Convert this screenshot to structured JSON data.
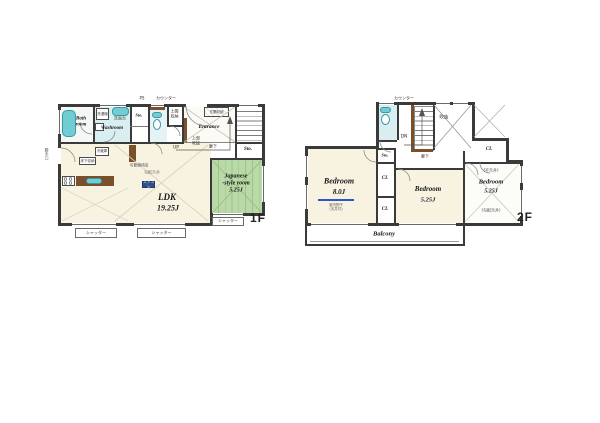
{
  "colors": {
    "wall": "#3a3a3a",
    "fixture_teal": "#72ccd4",
    "tatami_green": "#b9d9a7",
    "floor_cream": "#f8f3e1",
    "wet_floor_cyan": "#d8eef1",
    "wood_brown": "#7a4f2b",
    "laundry_blue": "#2b57c8"
  },
  "f1": {
    "floor": "1F",
    "ps": "PS",
    "counter": "カウンター",
    "bath_l1": "Bath",
    "bath_l2": "room",
    "washer": "洗濯機",
    "vanity": "洗面台",
    "washroom": "Washroom",
    "sto_hall": "Sto.",
    "doma_l1": "土間",
    "doma_l2": "収納",
    "genkan_sto": "玄関収納",
    "entrance": "Entrance",
    "up": "UP",
    "void_l1": "上部",
    "void_l2": "吹抜",
    "hallway": "廊下",
    "sto_east": "Sto.",
    "jp_l1": "Japanese",
    "jp_l2": "-style room",
    "jp_size": "5.25J",
    "ldk": "LDK",
    "ldk_size": "19.25J",
    "fridge": "冷蔵庫",
    "underfloor": "床下収納",
    "shelf": "可動棚4段",
    "ceiling": "勾配天井",
    "aircon": "エアコン",
    "backdoor": "勝手口",
    "shutter_a": "シャッター",
    "shutter_b": "シャッター",
    "shutter_c": "シャッター"
  },
  "f2": {
    "floor": "2F",
    "counter": "カウンター",
    "dn": "DN",
    "void": "吹抜",
    "hallway": "廊下",
    "sto": "Sto.",
    "cl_a": "CL",
    "cl_b": "CL",
    "cl_c": "CL",
    "bed1": "Bedroom",
    "bed1_size": "8.0J",
    "laundry_l1": "室内物干",
    "laundry_l2": "(天井付)",
    "bed2": "Bedroom",
    "bed2_size": "5.25J",
    "flat_ceiling": "(平天井)",
    "bed3": "Bedroom",
    "bed3_size": "5.25J",
    "sloped_ceiling": "(勾配天井)",
    "balcony": "Balcony"
  }
}
